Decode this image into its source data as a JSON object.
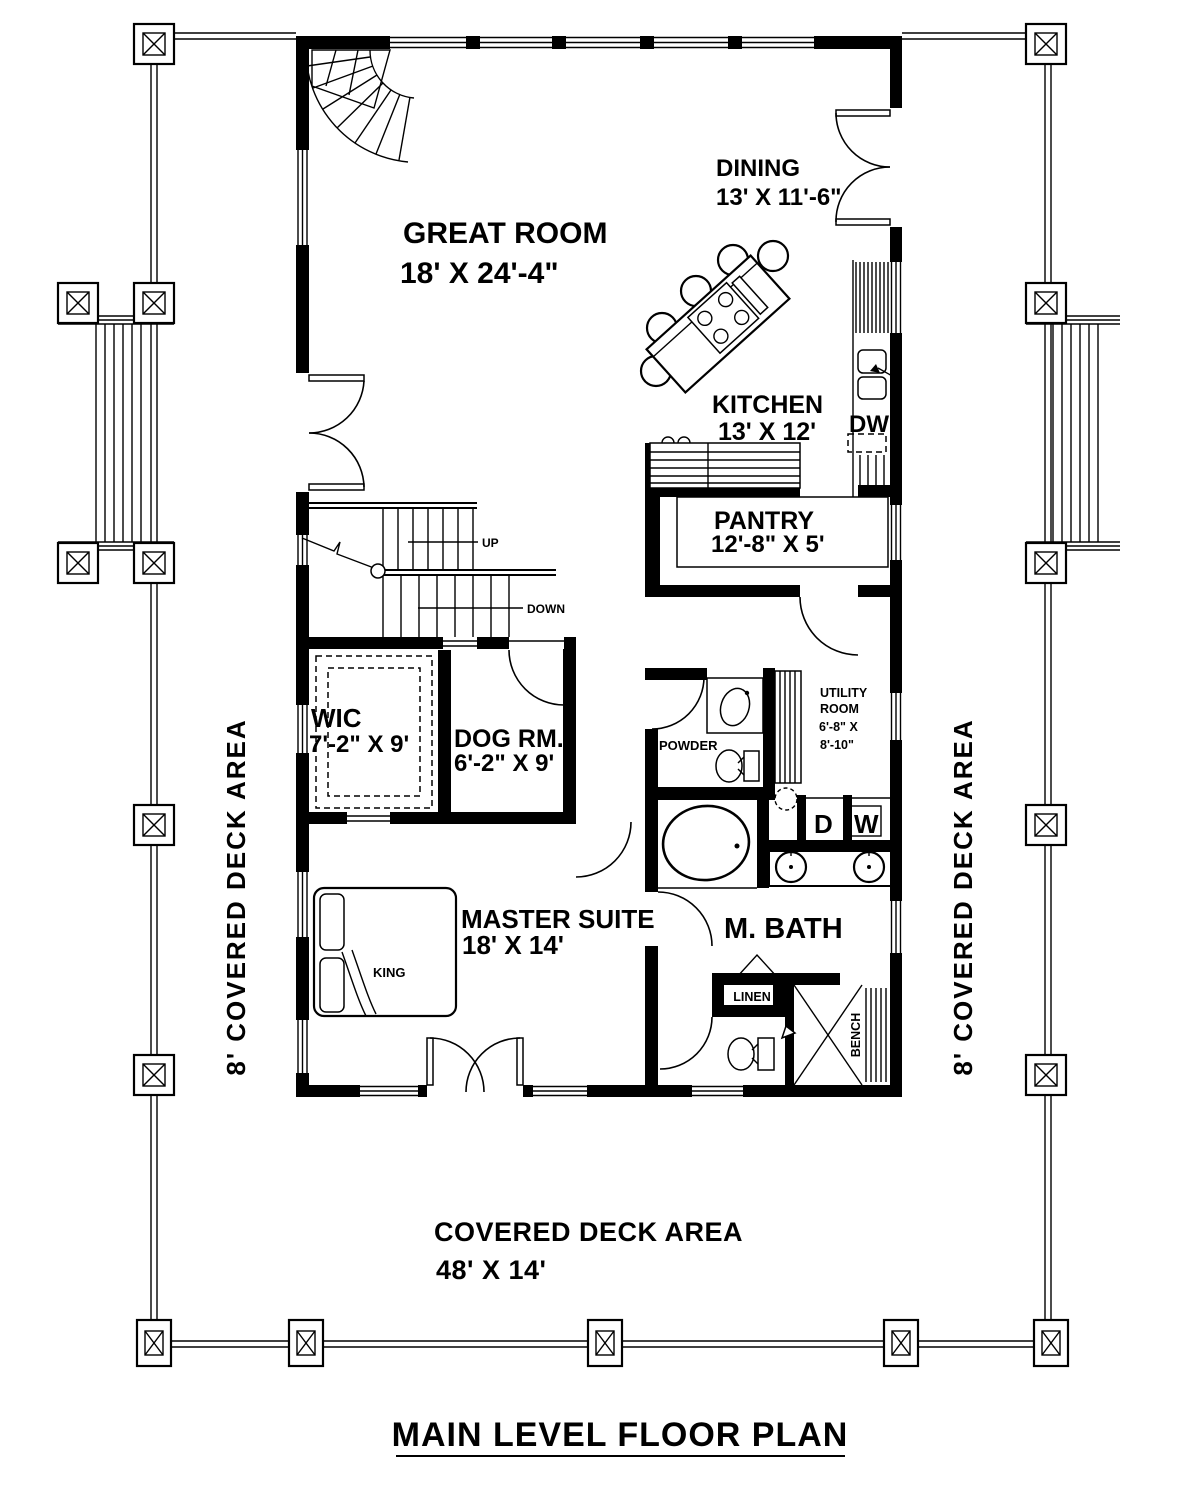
{
  "title": "MAIN LEVEL FLOOR PLAN",
  "rooms": {
    "great_room": {
      "name": "GREAT ROOM",
      "dims": "18' X 24'-4\""
    },
    "dining": {
      "name": "DINING",
      "dims": "13' X 11'-6\""
    },
    "kitchen": {
      "name": "KITCHEN",
      "dims": "13' X 12'"
    },
    "pantry": {
      "name": "PANTRY",
      "dims": "12'-8\" X 5'"
    },
    "wic": {
      "name": "WIC",
      "dims": "7'-2\" X 9'"
    },
    "dog_room": {
      "name": "DOG RM.",
      "dims": "6'-2\" X 9'"
    },
    "powder": {
      "name": "POWDER"
    },
    "utility": {
      "name_line1": "UTILITY",
      "name_line2": "ROOM",
      "dims_line1": "6'-8\" X",
      "dims_line2": "8'-10\""
    },
    "master_suite": {
      "name": "MASTER SUITE",
      "dims": "18' X 14'"
    },
    "master_bath": {
      "name": "M. BATH"
    },
    "linen": {
      "name": "LINEN"
    },
    "bench": {
      "name": "BENCH"
    },
    "king_bed": {
      "name": "KING"
    }
  },
  "stairs": {
    "up": "UP",
    "down": "DOWN"
  },
  "appliances": {
    "dryer": "D",
    "washer": "W",
    "dishwasher": "DW"
  },
  "decks": {
    "left": "8' COVERED DECK AREA",
    "right": "8' COVERED DECK AREA",
    "bottom": {
      "name": "COVERED DECK AREA",
      "dims": "48' X 14'"
    }
  },
  "colors": {
    "line": "#000000",
    "background": "#ffffff"
  }
}
